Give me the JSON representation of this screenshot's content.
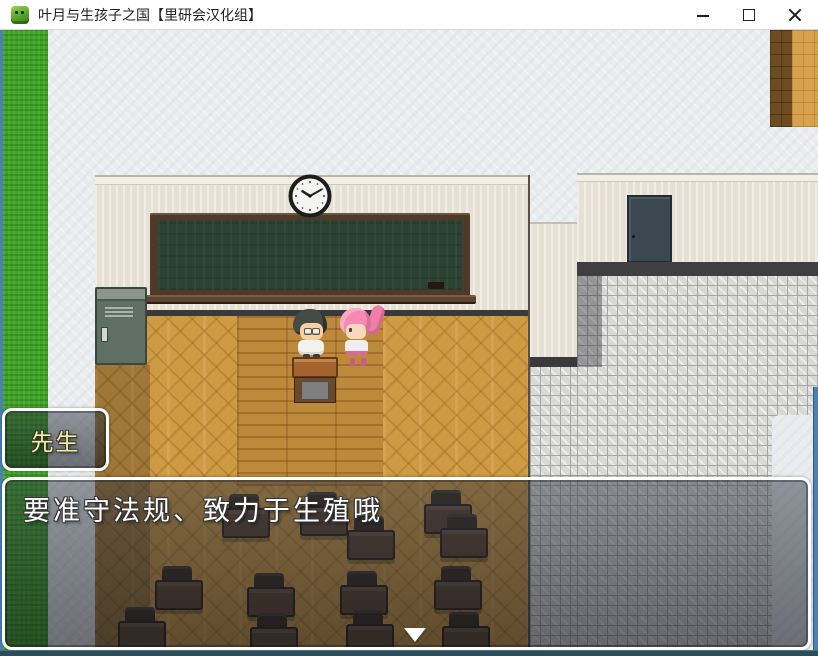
{
  "window": {
    "title": "叶月与生孩子之国【里研会汉化组】",
    "controls": {
      "minimize": "minimize",
      "maximize": "maximize",
      "close": "close"
    }
  },
  "hud": {
    "name_box": {
      "text": "先生"
    },
    "message_box": {
      "text": "要准守法规、致力于生殖哦"
    }
  },
  "icons": {
    "app_icon": "green-rpg-sprite-icon",
    "minimize_icon": "horizontal-bar",
    "maximize_icon": "square-outline",
    "close_icon": "x-cross",
    "continue_indicator": "down-triangle",
    "wall_clock": "analog-clock-about-10-10"
  },
  "colors": {
    "titlebar_bg": "#ffffff",
    "grass": "#3fa32a",
    "wood_floor": "#cf9a44",
    "chalkboard": "#2c4233",
    "wall": "#e7e1d5",
    "tiles": "#d8d8d6",
    "name_text": "#f7ef9e",
    "message_text": "#ffffff",
    "message_border": "#ffffff",
    "bottom_frame": "#2a4d59"
  }
}
